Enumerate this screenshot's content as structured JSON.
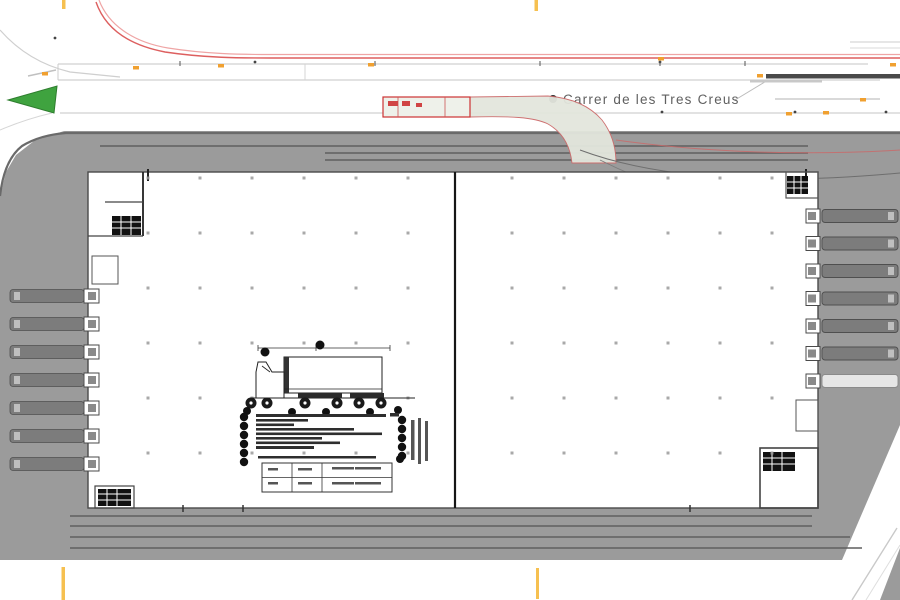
{
  "street": {
    "label": "Carrer de les Tres Creus"
  },
  "site": {
    "loading_docks_left": 7,
    "loading_docks_right": 7,
    "trucks_parked_left": 7,
    "trucks_parked_right": 6,
    "building_halves": 2
  },
  "colors": {
    "pavement": "#9b9b9b",
    "pavement_edge": "#6a6a6a",
    "lane_marking": "#5f5f5f",
    "red_guideline": "#dd5f5f",
    "red_guideline_light": "#efa5a5",
    "swept_path_fill": "#e3e6dd",
    "swept_path_edge": "#cc6a6a",
    "orange_marker": "#f0a030",
    "fold_tick": "#f6c050",
    "green_island": "#3fa33f",
    "wall": "#4a4a4a",
    "truck": "#7c7c7c",
    "truck_empty": "#bdbdbd",
    "stair_block": "#111111"
  }
}
